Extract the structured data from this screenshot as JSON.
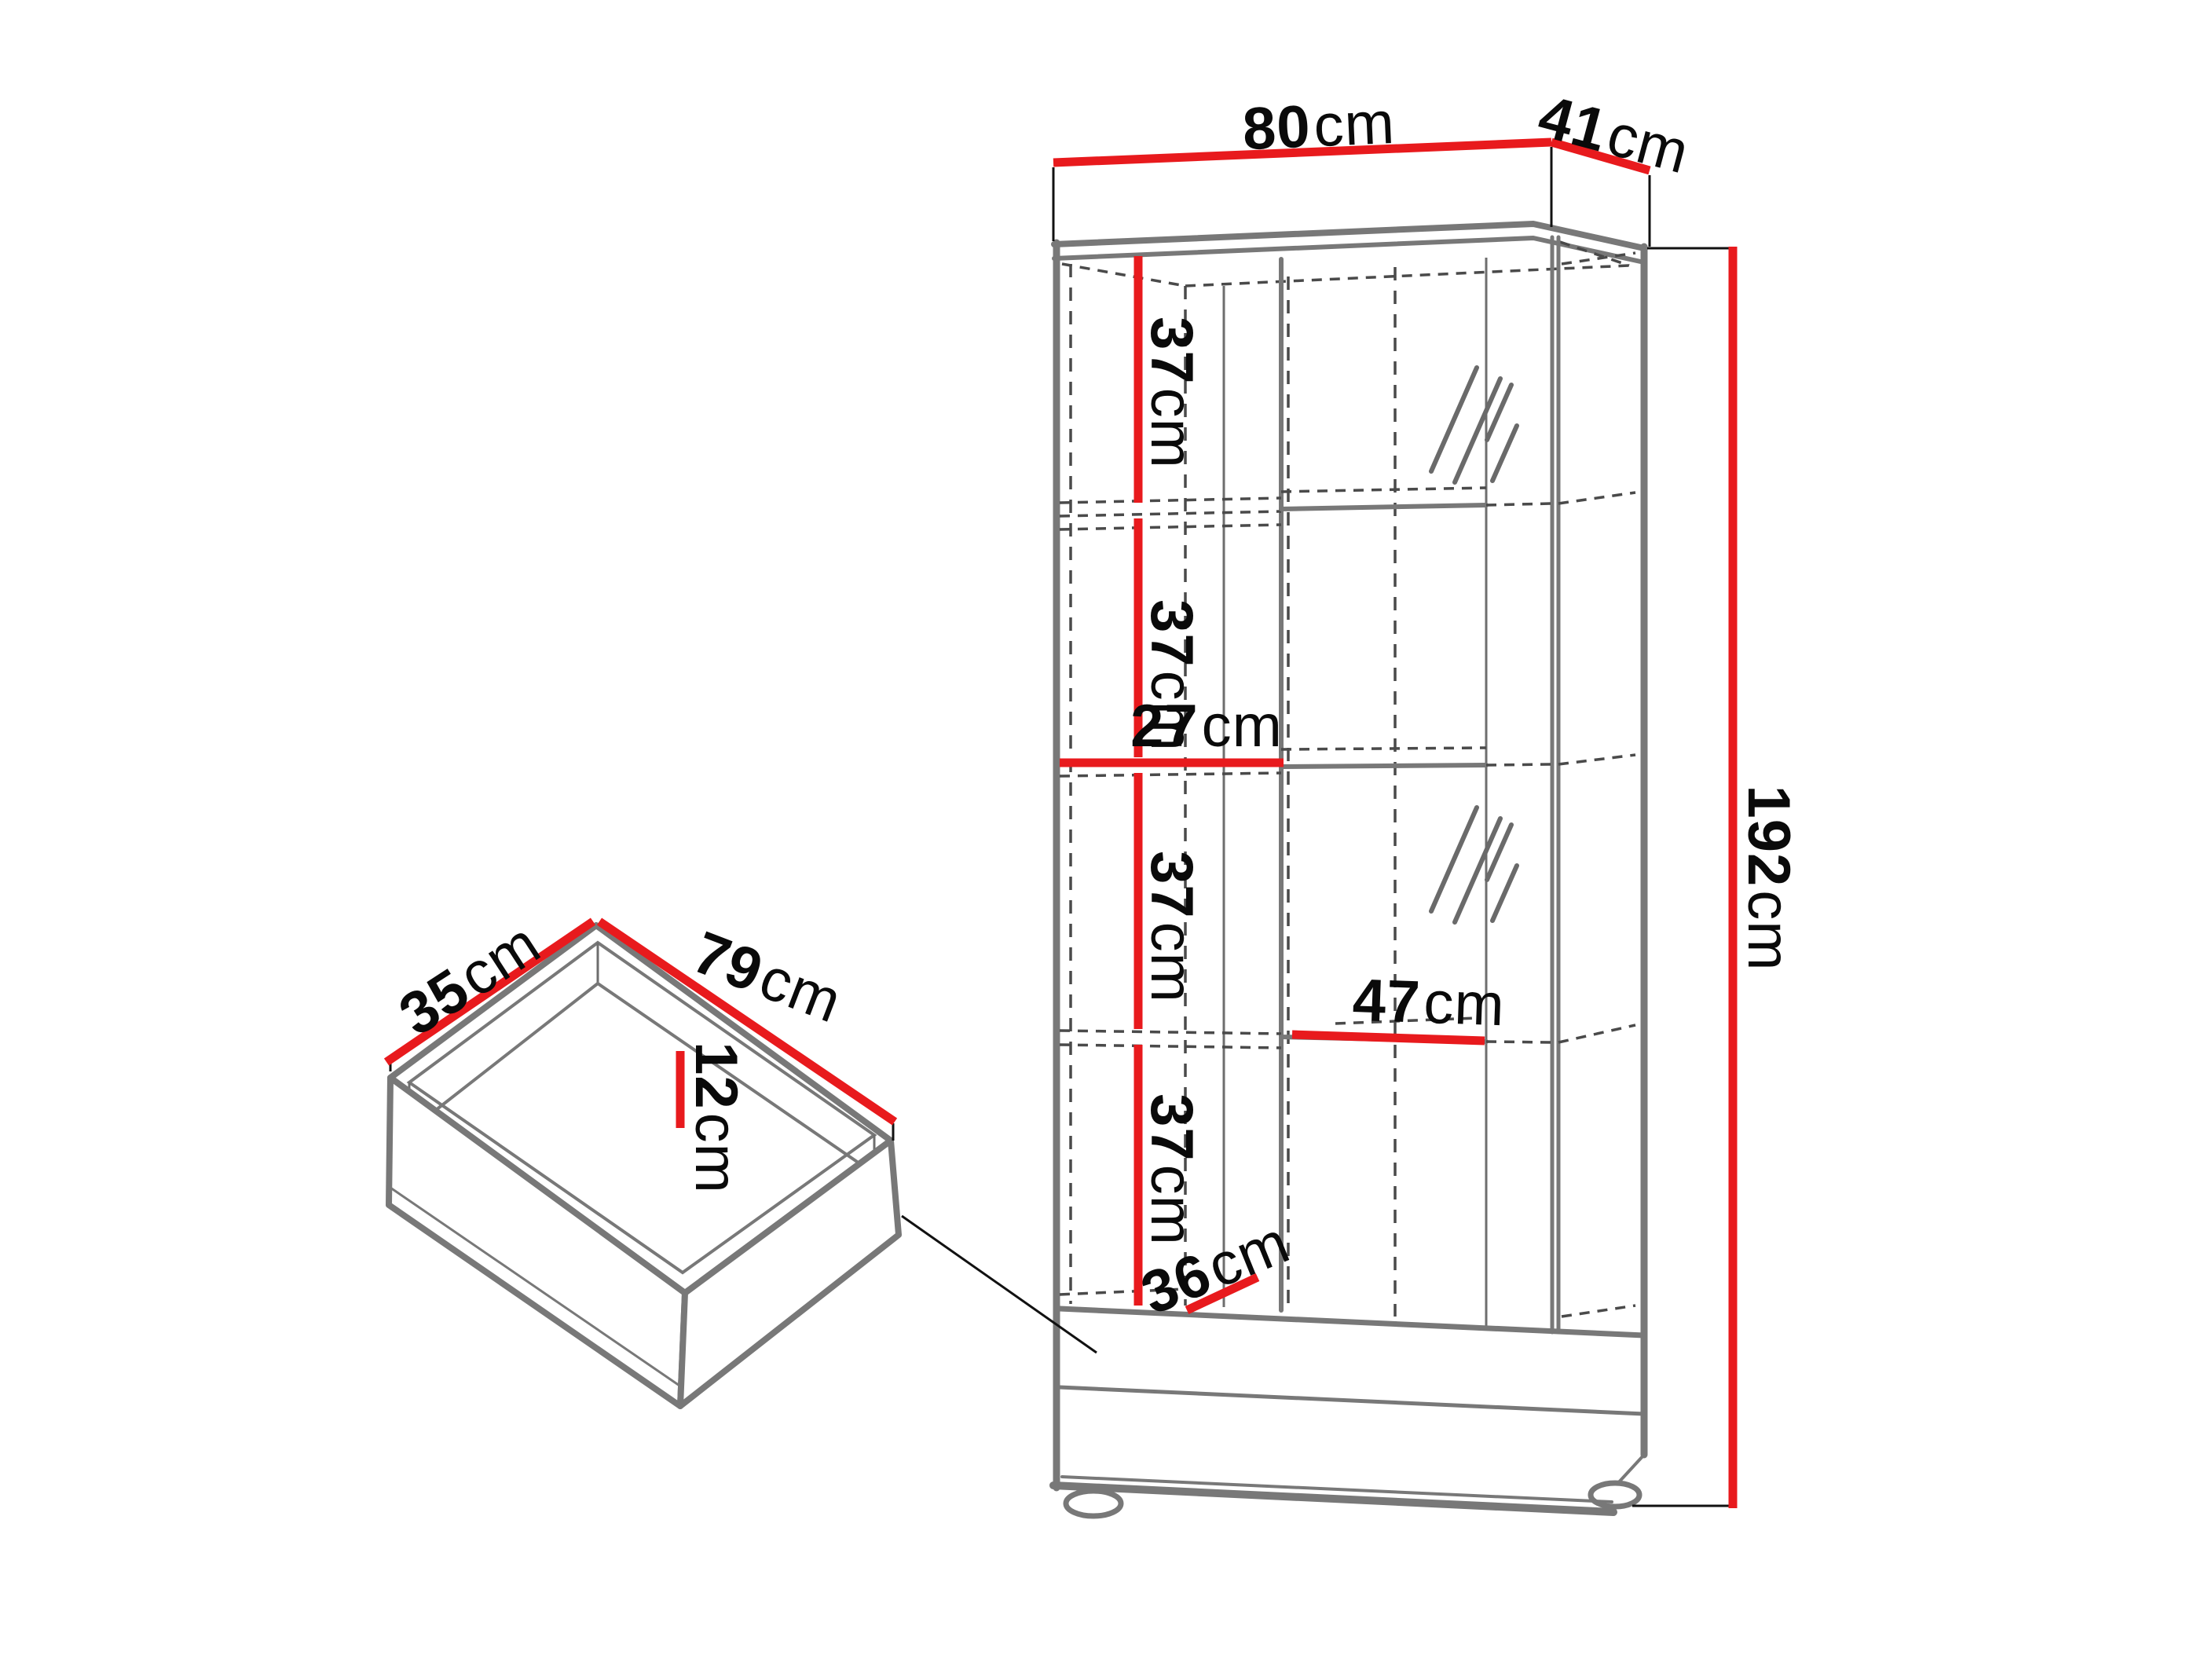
{
  "diagram": {
    "type": "furniture-dimension-diagram",
    "subject": "tall display cabinet with two drawers, plus detail view of extracted drawer box"
  },
  "colors": {
    "accent_red": "#e81a1d",
    "line_gray": "#787878",
    "dash_gray": "#4a4a4a",
    "text": "#0a0a0a",
    "background": "#ffffff"
  },
  "cabinet": {
    "width": {
      "value": "80",
      "unit": "cm"
    },
    "depth": {
      "value": "41",
      "unit": "cm"
    },
    "height": {
      "value": "192",
      "unit": "cm"
    },
    "shelf_spacings": [
      {
        "value": "37",
        "unit": "cm"
      },
      {
        "value": "37",
        "unit": "cm"
      },
      {
        "value": "37",
        "unit": "cm"
      },
      {
        "value": "37",
        "unit": "cm"
      }
    ],
    "left_compartment_width": {
      "value": "27",
      "unit": "cm"
    },
    "right_compartment_width": {
      "value": "47",
      "unit": "cm"
    },
    "interior_depth": {
      "value": "36",
      "unit": "cm"
    }
  },
  "drawer": {
    "width": {
      "value": "79",
      "unit": "cm"
    },
    "depth": {
      "value": "35",
      "unit": "cm"
    },
    "height": {
      "value": "12",
      "unit": "cm"
    }
  }
}
